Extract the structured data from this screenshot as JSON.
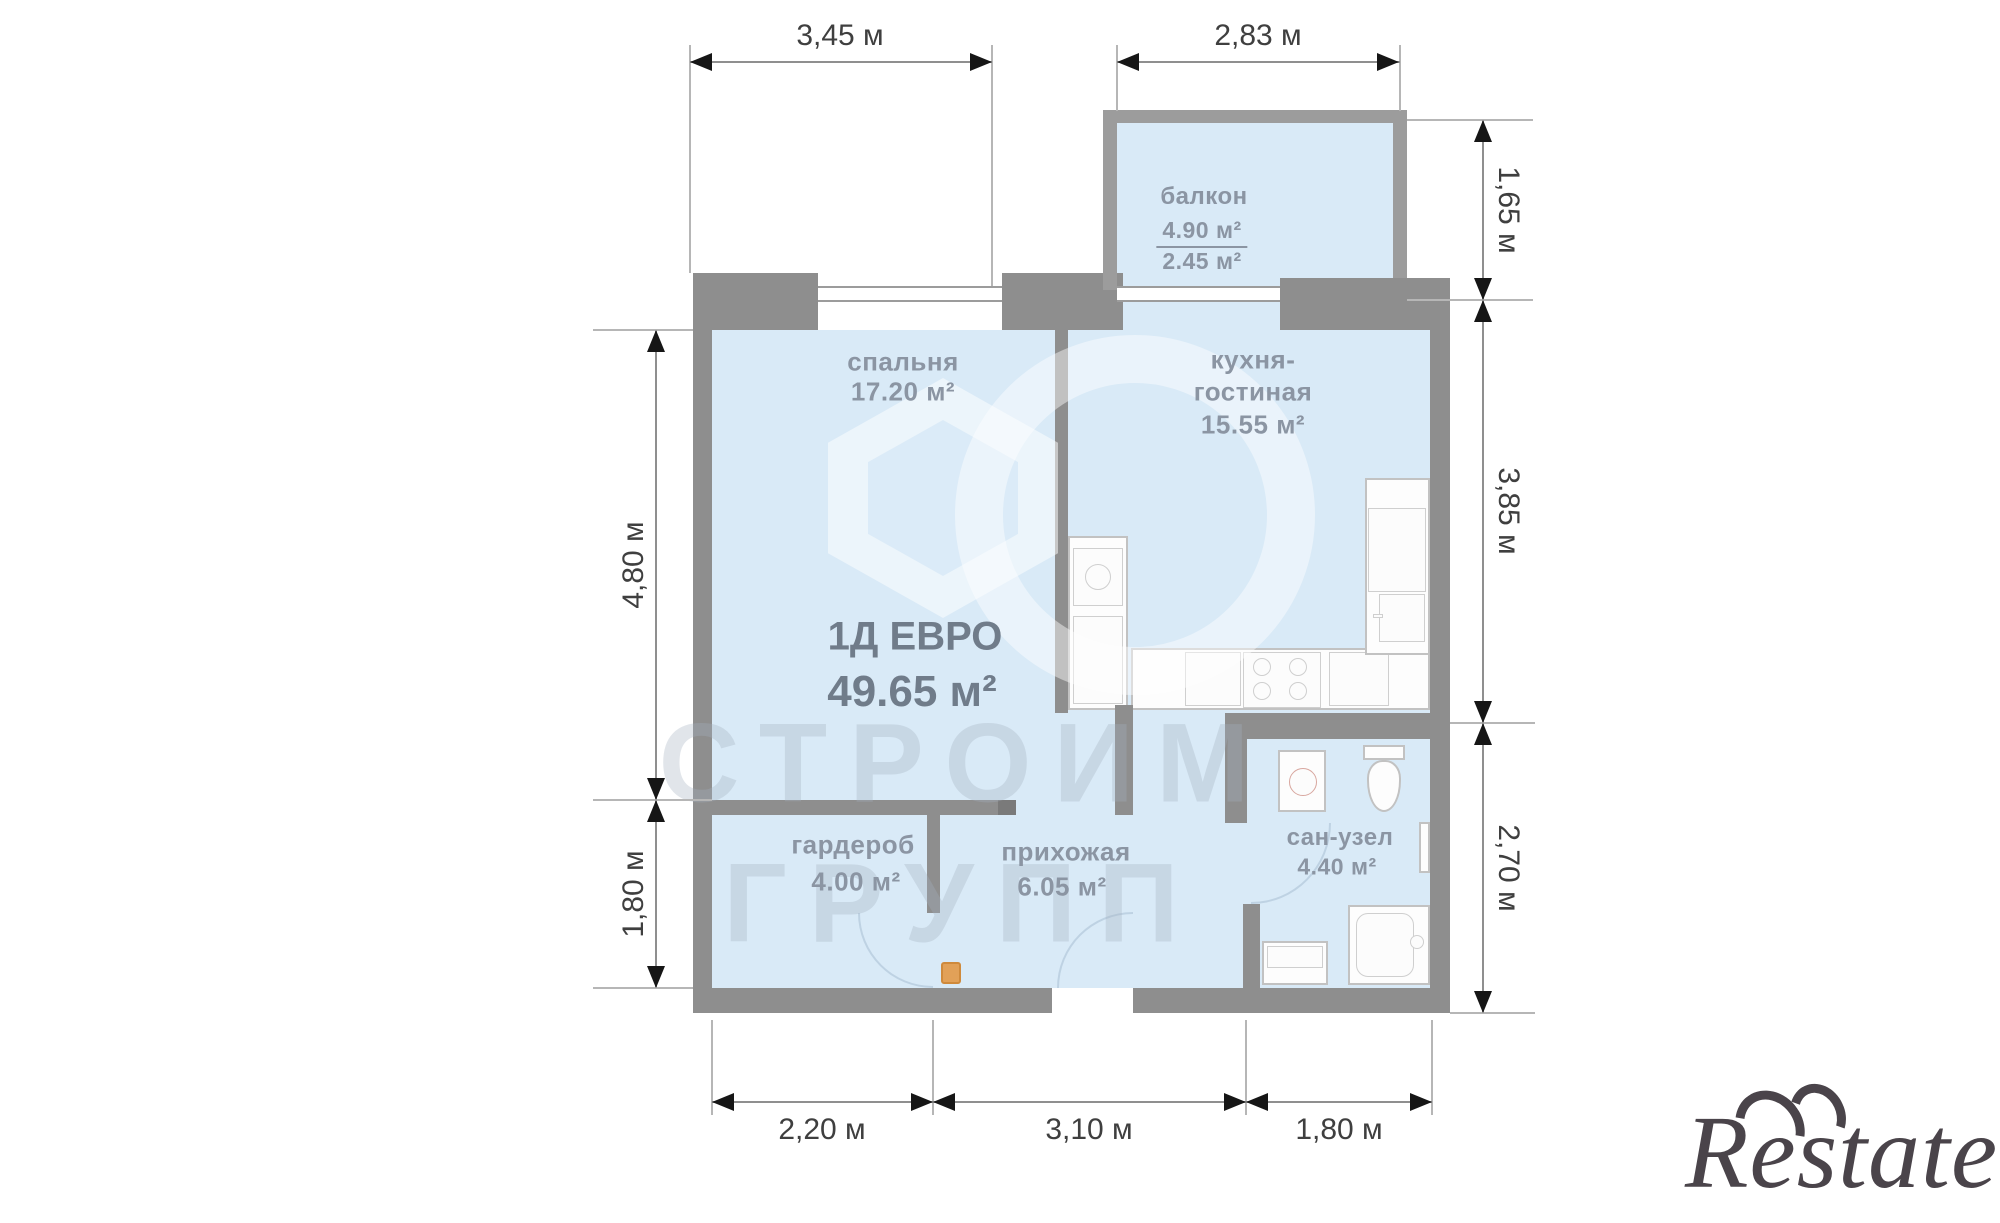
{
  "document": {
    "kind": "apartment floor plan"
  },
  "title": {
    "plan_code": "1Д ЕВРО",
    "total_area": "49.65 м²"
  },
  "rooms": {
    "bedroom": {
      "name": "спальня",
      "area": "17.20 м²"
    },
    "kitchen_living": {
      "name_line1": "кухня-",
      "name_line2": "гостиная",
      "area": "15.55 м²"
    },
    "balcony": {
      "name": "балкон",
      "area_full": "4.90 м²",
      "area_reduced": "2.45 м²"
    },
    "wardrobe": {
      "name": "гардероб",
      "area": "4.00 м²"
    },
    "hallway": {
      "name": "прихожая",
      "area": "6.05 м²"
    },
    "bathroom": {
      "name": "сан-узел",
      "area": "4.40 м²"
    }
  },
  "dimensions": {
    "top_bedroom": "3,45 м",
    "top_balcony": "2,83 м",
    "right_balcony": "1,65 м",
    "right_kitchen": "3,85 м",
    "right_bathroom": "2,70 м",
    "left_bedroom": "4,80 м",
    "left_wardrobe": "1,80 м",
    "bottom_wardrobe": "2,20 м",
    "bottom_hallway": "3,10 м",
    "bottom_bathroom": "1,80 м"
  },
  "watermark": {
    "line1": "СТРОИМ",
    "line2": "ГРУПП"
  },
  "brand": {
    "logo_text": "Restate"
  },
  "colors": {
    "wall": "#8e8e8e",
    "wall_light": "#9c9c9c",
    "room_fill": "#d9eaf7",
    "fixture_border": "#c2c2c2",
    "dim_line": "#8f8f8f",
    "dim_text": "#3f3f3f",
    "label_text": "#8b95a3",
    "title_text": "#707c8a",
    "door_accent": "#e2a158",
    "logo_color": "#4a444a"
  }
}
